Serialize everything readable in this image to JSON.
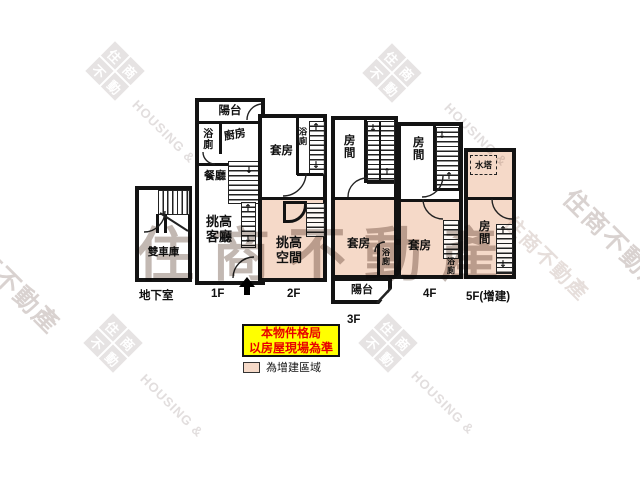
{
  "note": {
    "line1": "本物件格局",
    "line2": "以房屋現場為準"
  },
  "legend": {
    "addition_label": "為增建區域"
  },
  "colors": {
    "addition_fill": "#f5d9c8",
    "note_bg": "#ffff00",
    "note_text": "#e80000",
    "wall": "#131313",
    "watermark_gray": "#e6e3e3"
  },
  "icons": {
    "up_arrow": "↑",
    "down_arrow": "↓"
  },
  "floors": {
    "basement": {
      "label": "地下室",
      "garage": "雙車庫"
    },
    "f1": {
      "label": "1F",
      "balcony": "陽台",
      "bath": "浴廁",
      "kitchen": "廚房",
      "dining": "餐廳",
      "living": "挑高客廳"
    },
    "f2": {
      "label": "2F",
      "suite": "套房",
      "bath": "浴廁",
      "void": "挑高空間"
    },
    "f3": {
      "label": "3F",
      "room": "房間",
      "suite": "套房",
      "bath": "浴廁",
      "balcony": "陽台"
    },
    "f4": {
      "label": "4F",
      "room": "房間",
      "suite": "套房",
      "bath": "浴廁"
    },
    "f5": {
      "label": "5F(增建)",
      "tank": "水塔",
      "room": "房間"
    }
  },
  "watermark": {
    "brand_zh": "住商不動產",
    "brand_en": "HOUSING &",
    "logo": {
      "c1": "住",
      "c2": "商",
      "c3": "不",
      "c4": "動"
    }
  }
}
